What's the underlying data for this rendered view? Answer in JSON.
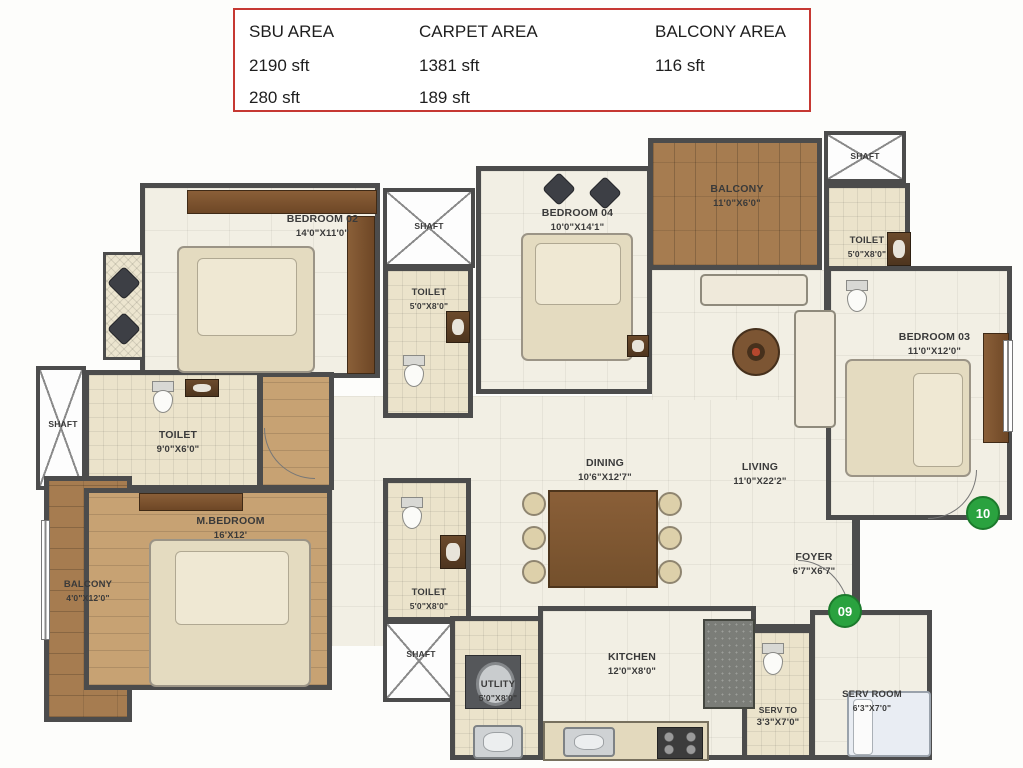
{
  "legend": {
    "columns": [
      {
        "header": "SBU AREA",
        "values": [
          "2190 sft",
          "280 sft"
        ]
      },
      {
        "header": "CARPET AREA",
        "values": [
          "1381 sft",
          "189 sft"
        ]
      },
      {
        "header": "BALCONY AREA",
        "values": [
          "116 sft"
        ]
      }
    ]
  },
  "rooms": {
    "bedroom02": {
      "name": "BEDROOM 02",
      "dims": "14'0\"X11'0\""
    },
    "bedroom03": {
      "name": "BEDROOM  03",
      "dims": "11'0\"X12'0\""
    },
    "bedroom04": {
      "name": "BEDROOM 04",
      "dims": "10'0\"X14'1\""
    },
    "mbedroom": {
      "name": "M.BEDROOM",
      "dims": "16'X12'"
    },
    "balcony_top": {
      "name": "BALCONY",
      "dims": "11'0\"X6'0\""
    },
    "balcony_left": {
      "name": "BALCONY",
      "dims": "4'0\"X12'0\""
    },
    "toilet_top_mid": {
      "name": "TOILET",
      "dims": "5'0\"X8'0\""
    },
    "toilet_top_right": {
      "name": "TOILET",
      "dims": "5'0\"X8'0\""
    },
    "toilet_left": {
      "name": "TOILET",
      "dims": "9'0\"X6'0\""
    },
    "toilet_mid": {
      "name": "TOILET",
      "dims": "5'0\"X8'0\""
    },
    "dining": {
      "name": "DINING",
      "dims": "10'6\"X12'7\""
    },
    "living": {
      "name": "LIVING",
      "dims": "11'0\"X22'2\""
    },
    "foyer": {
      "name": "FOYER",
      "dims": "6'7\"X6'7\""
    },
    "kitchen": {
      "name": "KITCHEN",
      "dims": "12'0\"X8'0\""
    },
    "utility": {
      "name": "UTLITY",
      "dims": "5'0\"X8'0\""
    },
    "serv_toilet": {
      "name": "SERV TO",
      "dims": "3'3\"X7'0\""
    },
    "serv_room": {
      "name": "SERV ROOM",
      "dims": "6'3\"X7'0\""
    }
  },
  "labels": {
    "shaft": "SHAFT"
  },
  "markers": {
    "m09": "09",
    "m10": "10"
  },
  "colors": {
    "legend_border": "#c63832",
    "wall": "#4c4c4c",
    "wood": "#a67c50",
    "floor": "#f2efe4",
    "marker_green": "#2aa23f"
  }
}
